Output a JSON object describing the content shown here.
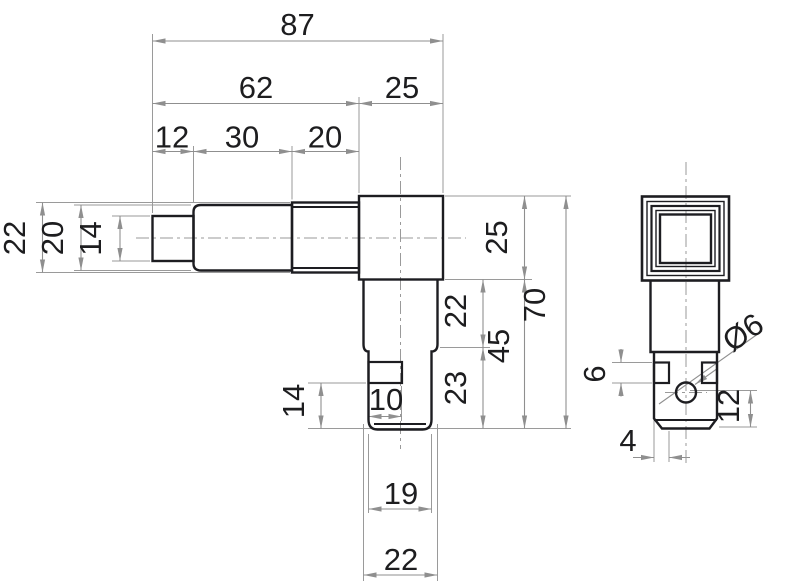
{
  "drawing_type": "technical-orthographic-dimension-drawing",
  "front_view": {
    "top_dims": {
      "total_length": "87",
      "shaft_length": "62",
      "head_length": "25",
      "tip_segment": "12",
      "mid_segment": "30",
      "collar_segment": "20"
    },
    "left_dims": {
      "collar_height": "22",
      "mid_height": "20",
      "tip_height": "14"
    },
    "right_dims": {
      "head_height": "25",
      "leg_upper_height": "22",
      "leg_lower_height": "23",
      "leg_total_height": "45",
      "overall_height": "70"
    },
    "bottom_dims": {
      "slot_width": "10",
      "slot_to_bottom": "14",
      "lower_width": "19",
      "leg_width": "22"
    }
  },
  "side_view": {
    "dims": {
      "hole_diameter": "Ø6",
      "notch_height": "6",
      "notch_depth": "4",
      "hole_to_bottom": "12"
    }
  },
  "colors": {
    "outline": "#1d1d21",
    "dimension_lines": "#8f8f8f",
    "text": "#1d1d1f",
    "background": "#ffffff"
  }
}
